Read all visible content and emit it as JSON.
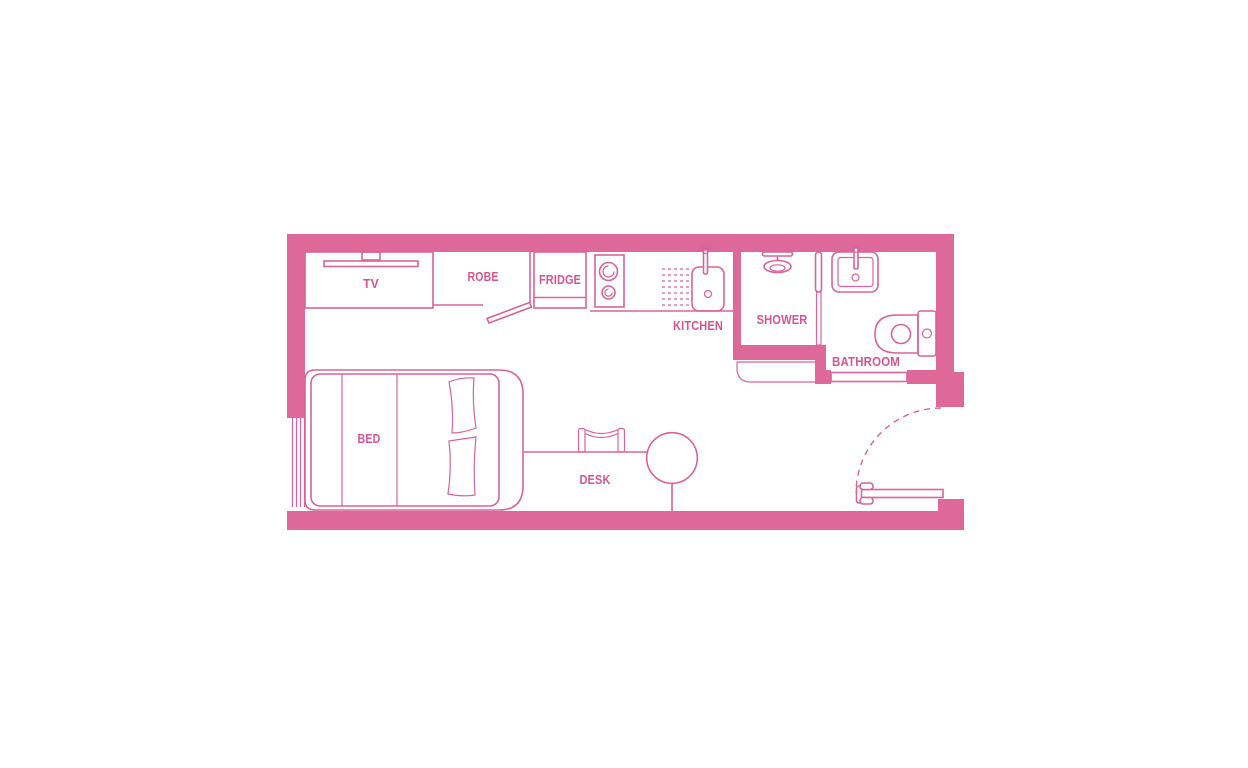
{
  "floor_plan": {
    "rooms": {
      "kitchen": "KITCHEN",
      "shower": "SHOWER",
      "bathroom": "BATHROOM"
    },
    "furniture": {
      "tv": "TV",
      "robe": "ROBE",
      "fridge": "FRIDGE",
      "bed": "BED",
      "desk": "DESK"
    }
  },
  "colors": {
    "wall": "#dd6899",
    "line": "#d9639b",
    "text": "#d6548f",
    "background": "#ffffff"
  }
}
